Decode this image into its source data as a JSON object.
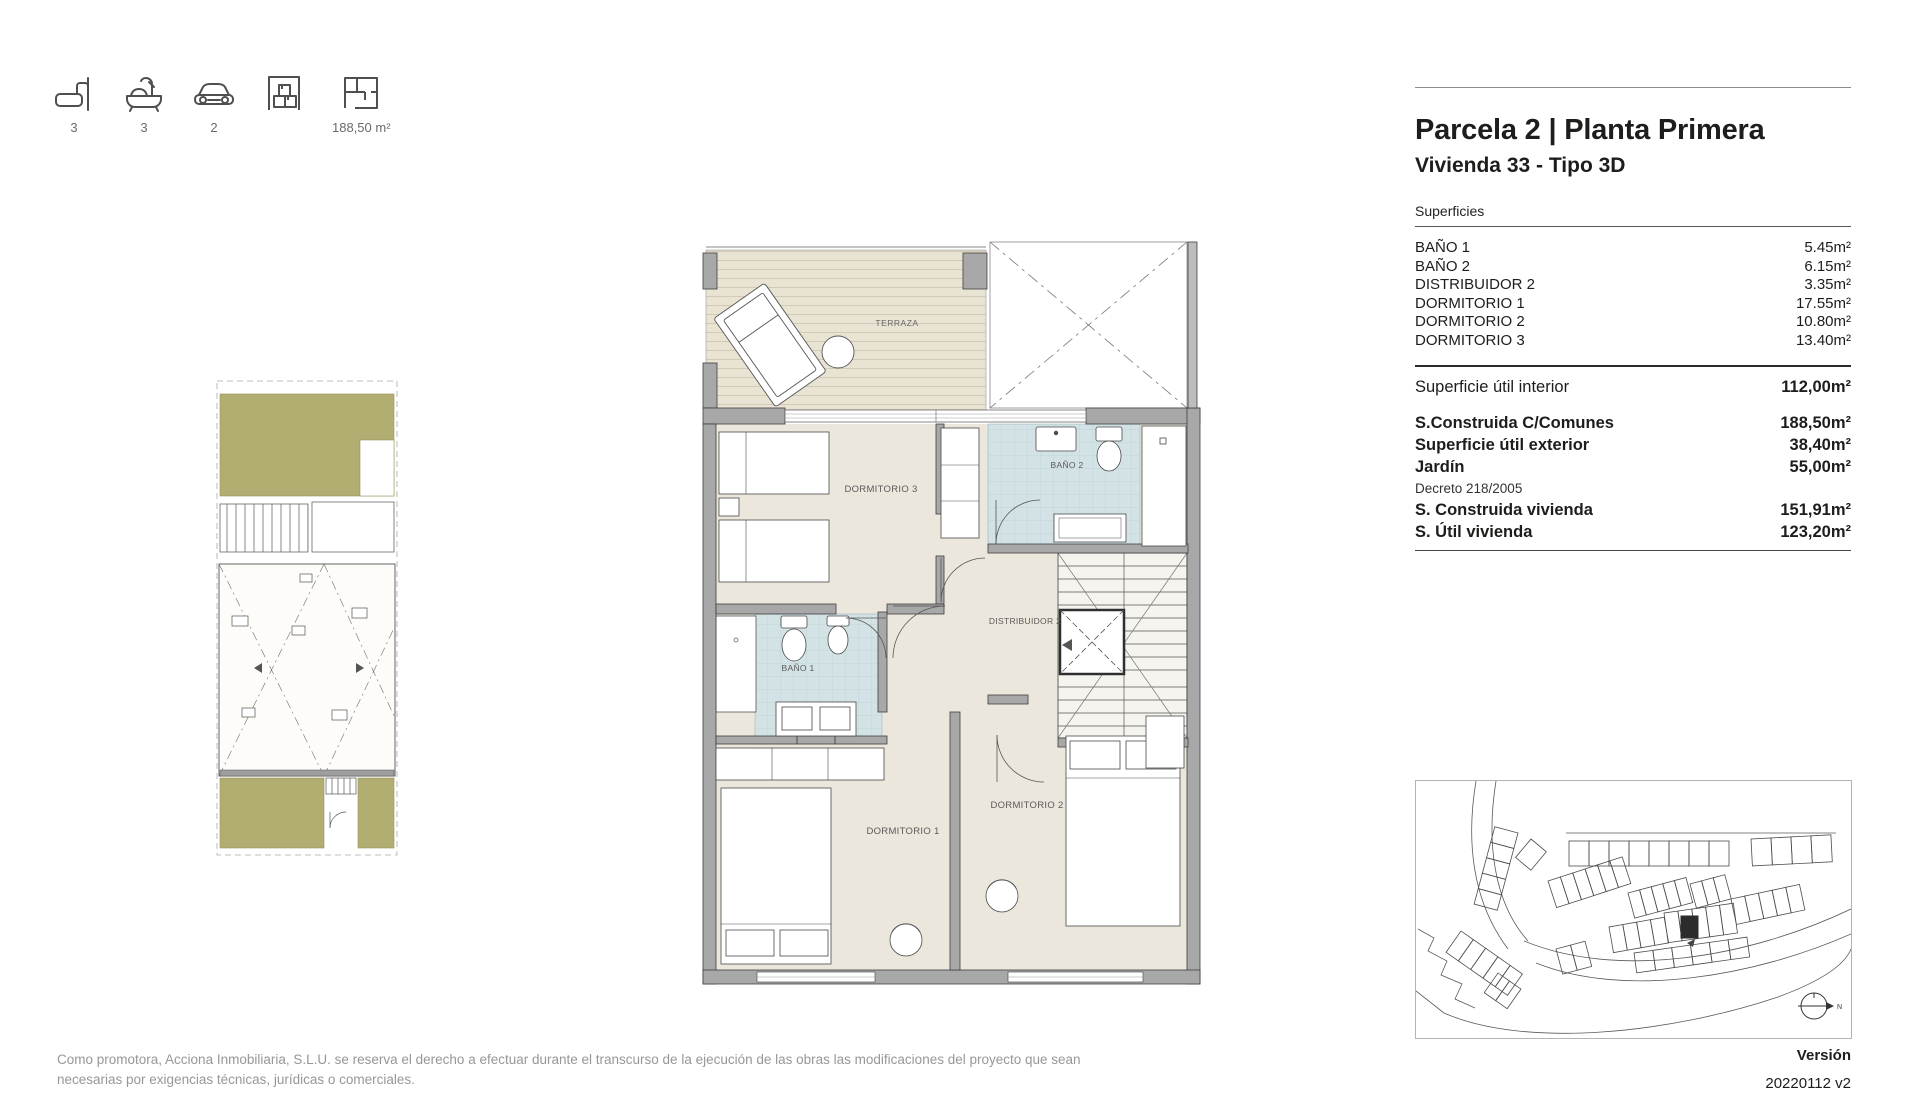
{
  "header": {
    "title": "Parcela 2 | Planta Primera",
    "subtitle": "Vivienda 33 - Tipo 3D"
  },
  "summary": {
    "items": [
      {
        "name": "bedrooms",
        "icon": "bed-icon",
        "value": "3"
      },
      {
        "name": "bathrooms",
        "icon": "bath-icon",
        "value": "3"
      },
      {
        "name": "parking",
        "icon": "car-icon",
        "value": "2"
      },
      {
        "name": "storage",
        "icon": "storage-icon",
        "value": ""
      },
      {
        "name": "built-area",
        "icon": "floorplan-icon",
        "value": "188,50 m²"
      }
    ]
  },
  "surfaces": {
    "section_title": "Superficies",
    "rooms": [
      {
        "label": "BAÑO 1",
        "value": "5.45m²"
      },
      {
        "label": "BAÑO 2",
        "value": "6.15m²"
      },
      {
        "label": "DISTRIBUIDOR 2",
        "value": "3.35m²"
      },
      {
        "label": "DORMITORIO 1",
        "value": "17.55m²"
      },
      {
        "label": "DORMITORIO 2",
        "value": "10.80m²"
      },
      {
        "label": "DORMITORIO 3",
        "value": "13.40m²"
      }
    ],
    "totals": [
      {
        "label": "Superficie útil interior",
        "value": "112,00m²"
      },
      {
        "label": "S.Construida C/Comunes",
        "value": "188,50m²"
      },
      {
        "label": "Superficie útil exterior",
        "value": "38,40m²"
      },
      {
        "label": "Jardín",
        "value": "55,00m²"
      },
      {
        "label": "Decreto 218/2005",
        "value": ""
      },
      {
        "label": "S. Construida vivienda",
        "value": "151,91m²"
      },
      {
        "label": "S. Útil vivienda",
        "value": "123,20m²"
      }
    ]
  },
  "floorplan": {
    "labels": {
      "terraza": "TERRAZA",
      "dormitorio3": "DORMITORIO 3",
      "bano2": "BAÑO 2",
      "distribuidor2": "DISTRIBUIDOR 2",
      "bano1": "BAÑO 1",
      "dormitorio1": "DORMITORIO 1",
      "dormitorio2": "DORMITORIO 2"
    }
  },
  "siteplan": {
    "north_label": "N"
  },
  "footer": {
    "disclaimer_line1": "Como promotora, Acciona Inmobiliaria, S.L.U. se reserva el derecho a efectuar durante el transcurso de la ejecución de las obras las modificaciones del proyecto que sean",
    "disclaimer_line2": "necesarias por exigencias técnicas, jurídicas o comerciales.",
    "version_label": "Versión",
    "version_value": "20220112 v2"
  },
  "colors": {
    "room_fill": "#ece7dc",
    "deck_fill": "#e9e3d3",
    "tile_fill": "#d3e2e5",
    "wall_fill": "#a8a8a8",
    "garden_fill": "#b2ae72",
    "text_dark": "#1d1d1b",
    "text_gray": "#979797"
  }
}
